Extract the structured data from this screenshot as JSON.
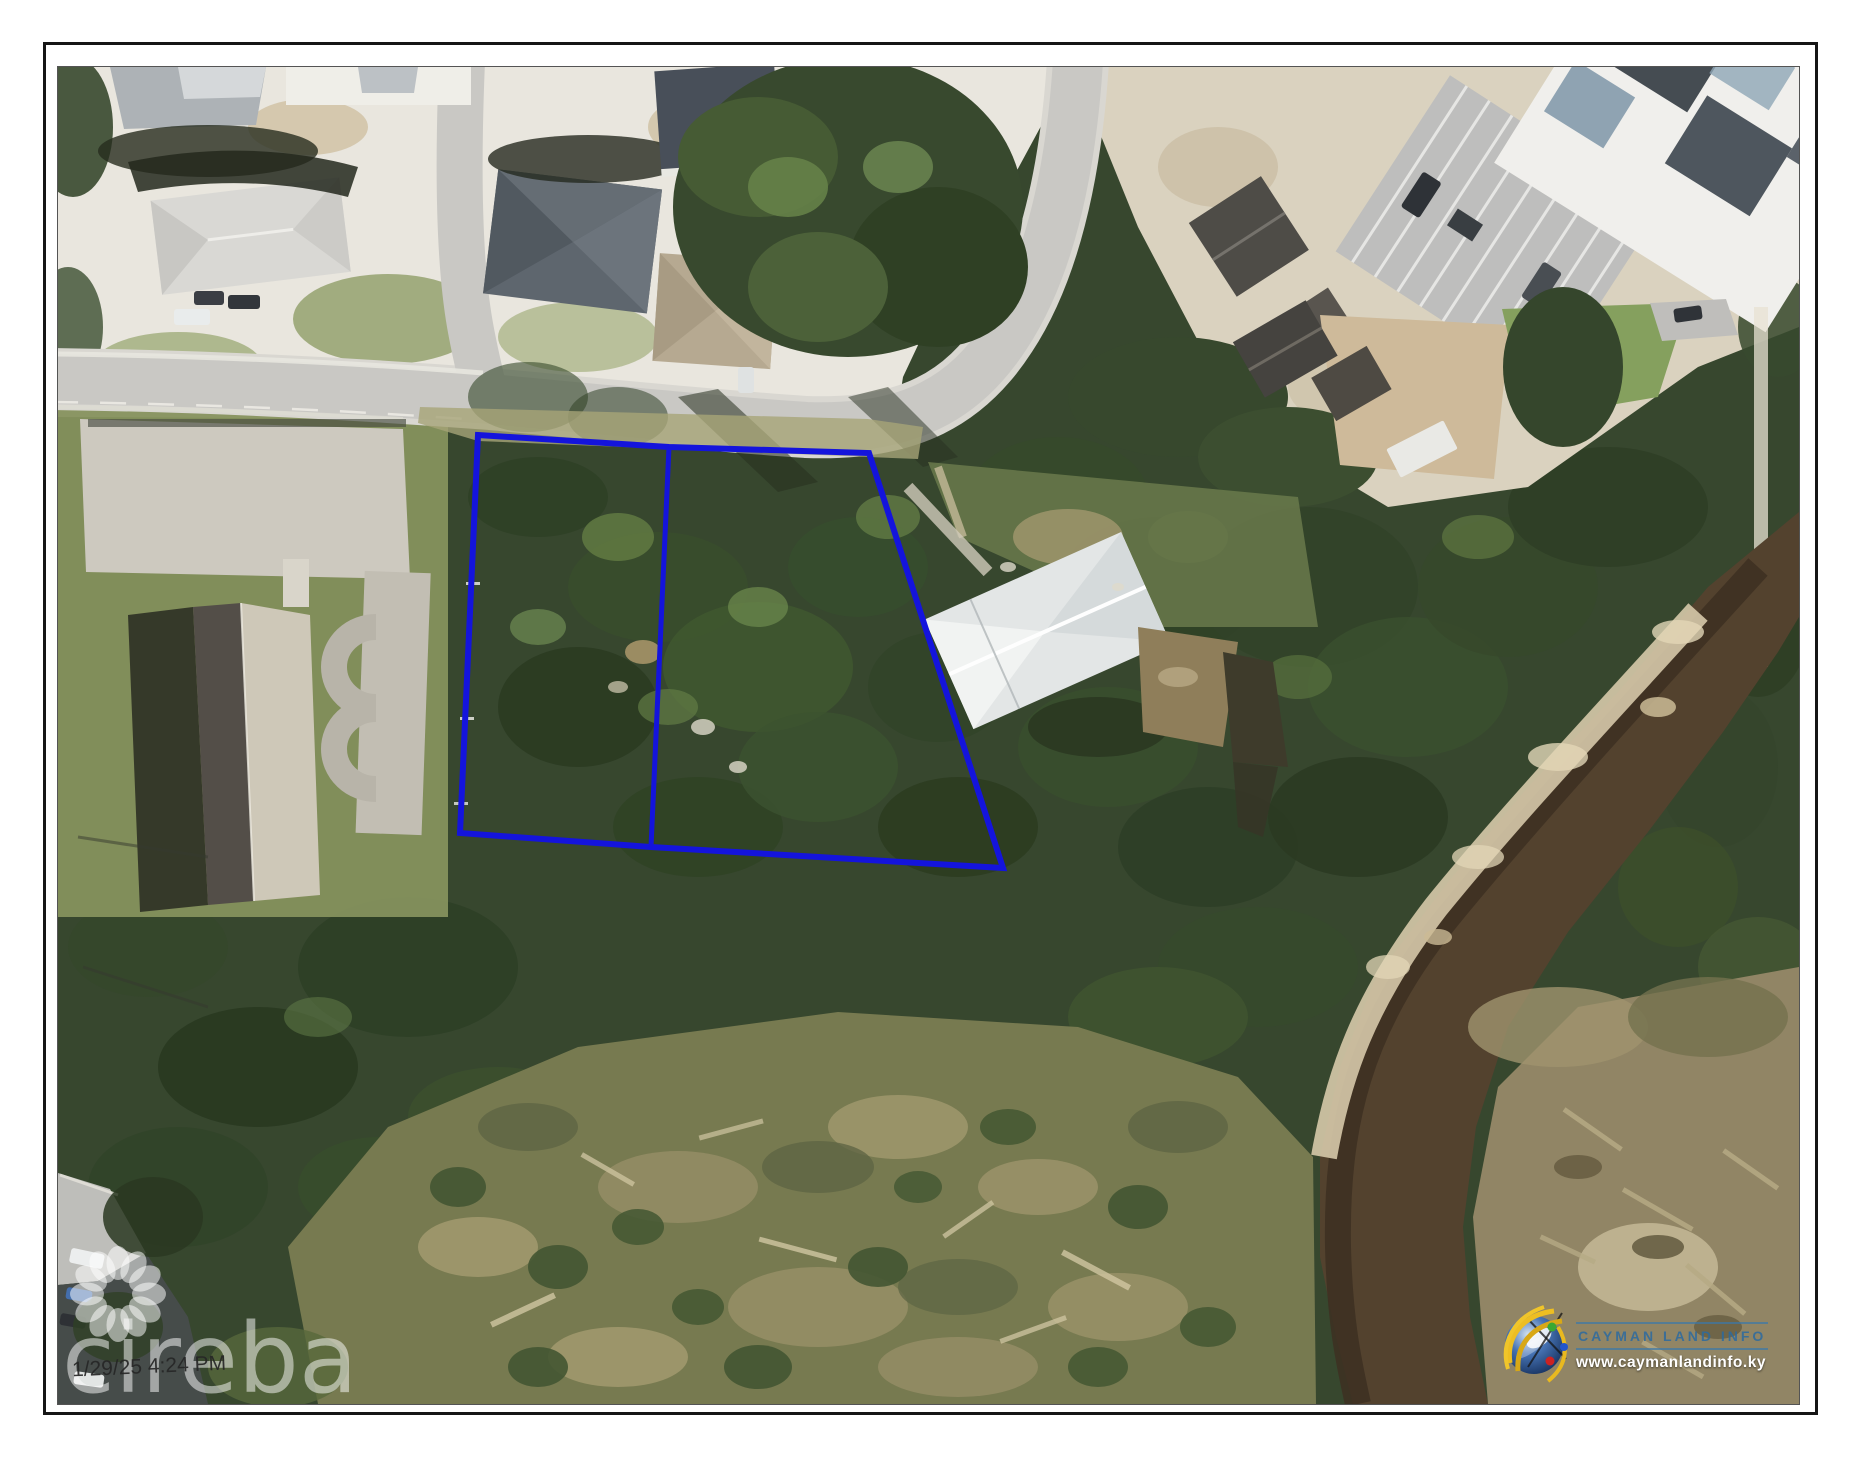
{
  "page": {
    "background_color": "#ffffff",
    "frame_border_color": "#161616",
    "photo_border_color": "#545454"
  },
  "map": {
    "type": "aerial-satellite-photo",
    "subject": "two vacant land parcels outlined in blue beside a road, mangrove forest and water channel",
    "parcel_outline_color": "#1414dc",
    "parcel_outline_points": "420,368 611,380 811,386 945,801 593,780 402,766",
    "parcel_divider_points": "611,380 593,780"
  },
  "watermarks": {
    "brand": "cireba",
    "brand_color": "rgba(255,255,255,0.5)",
    "timestamp": "1/29/25 4:24 PM"
  },
  "branding": {
    "name": "CAYMAN LAND INFO",
    "website": "www.caymanlandinfo.ky",
    "name_color": "#2c6aa0",
    "website_color": "#ffffff",
    "globe_colors": {
      "sphere": "#2a4f8f",
      "arcs": "#e9b91f",
      "dot_green": "#3aa832",
      "dot_red": "#cc2222",
      "dot_blue": "#2255cc"
    }
  }
}
